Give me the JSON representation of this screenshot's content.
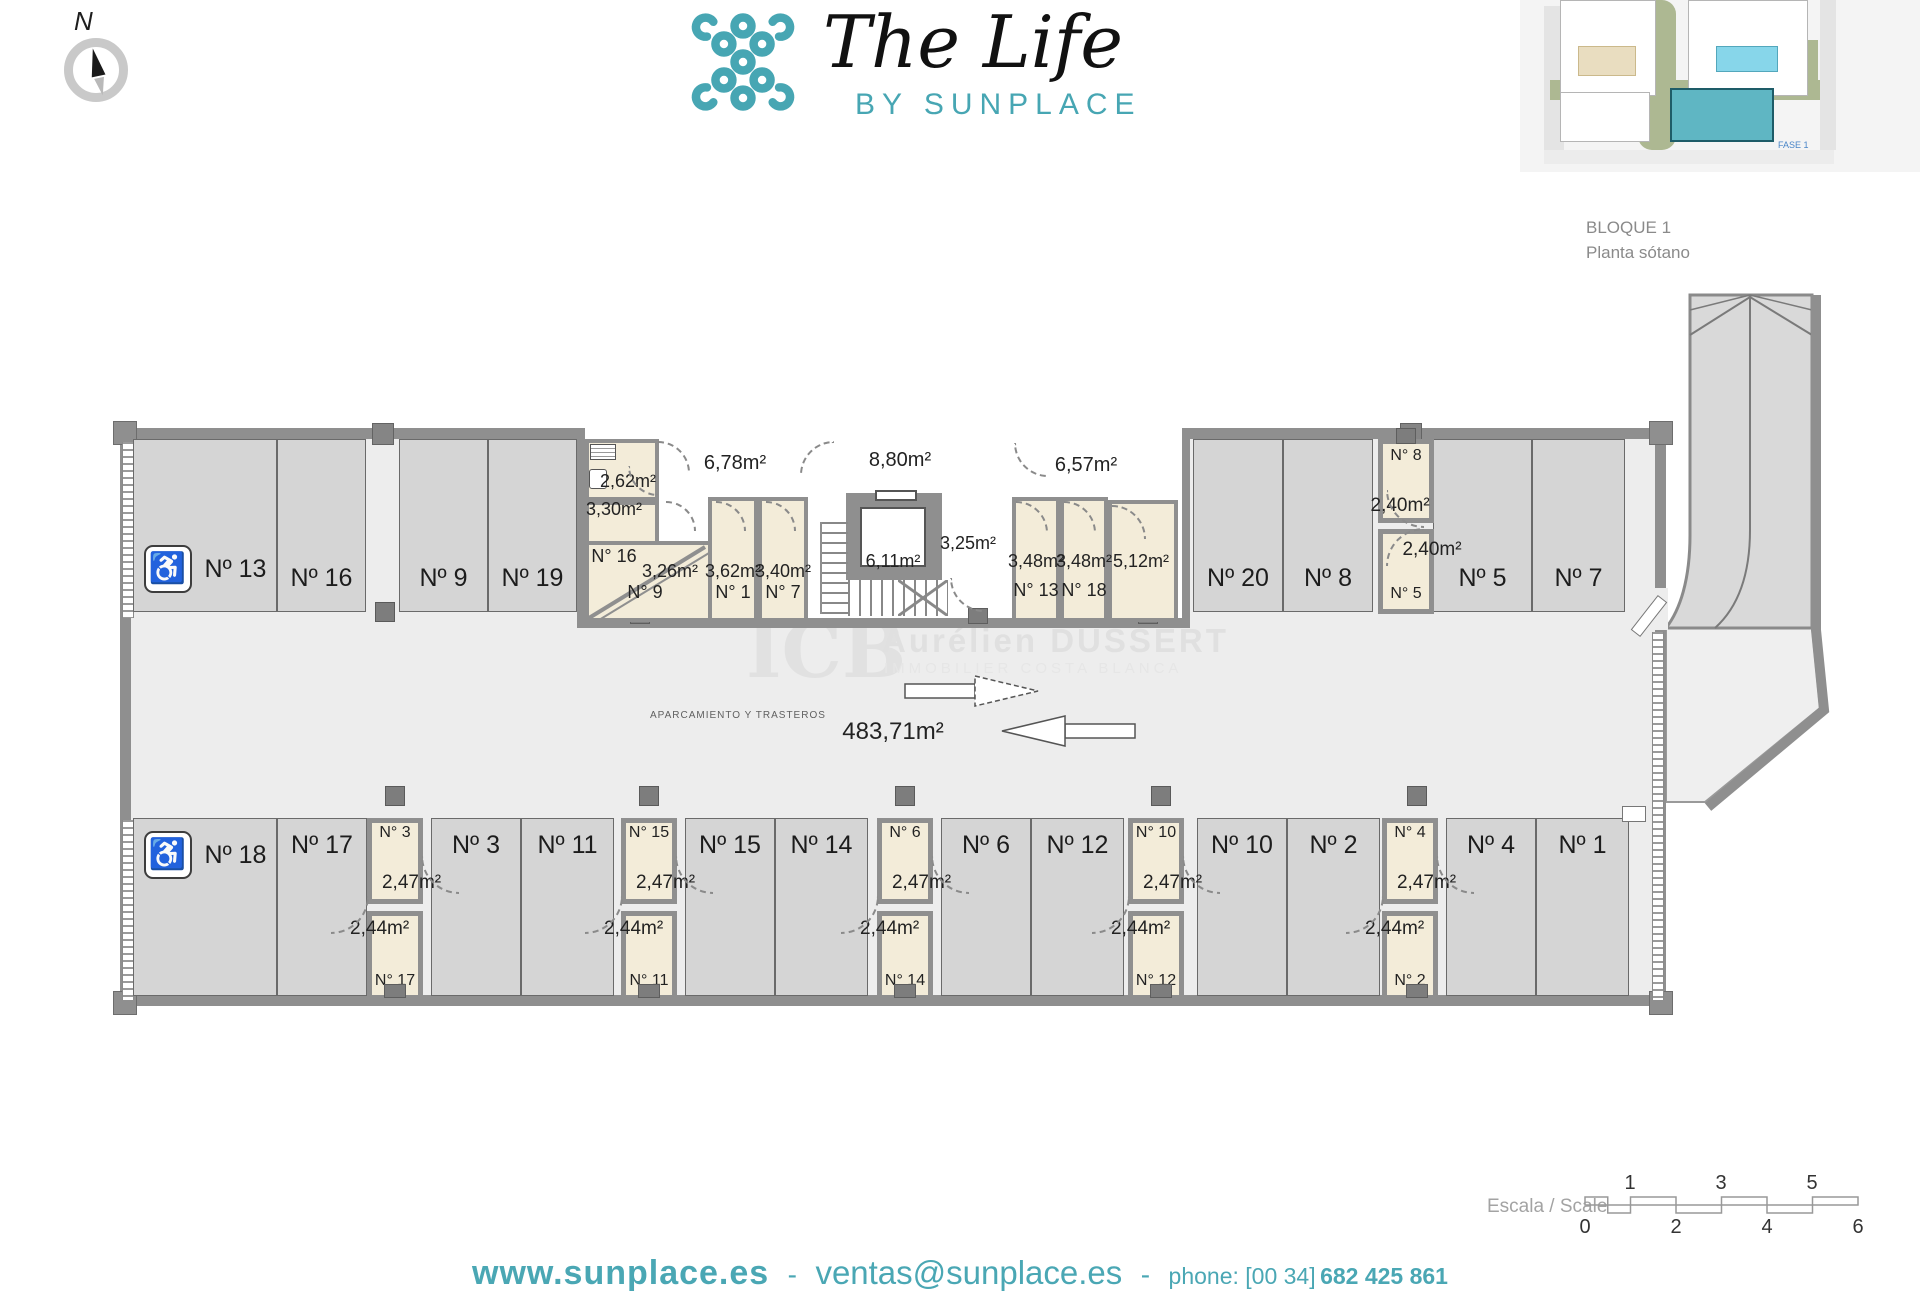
{
  "header": {
    "compass_label": "N",
    "logo_title": "The Life",
    "logo_subtitle": "BY SUNPLACE",
    "block_title": "BLOQUE 1",
    "block_subtitle": "Planta sótano",
    "sitemap_phase_label": "FASE 1"
  },
  "plan": {
    "garage_label": "APARCAMIENTO Y TRASTEROS",
    "garage_area": "483,71m²",
    "top_row": [
      {
        "label": "Nº 13",
        "accessible": true
      },
      {
        "label": "Nº 16"
      },
      {
        "label": "Nº 9"
      },
      {
        "label": "Nº 19"
      },
      {
        "label": "Nº 20"
      },
      {
        "label": "Nº 8"
      },
      {
        "label": "Nº 5"
      },
      {
        "label": "Nº 7"
      }
    ],
    "bottom_row": [
      {
        "label": "Nº 18",
        "accessible": true
      },
      {
        "label": "Nº 17"
      },
      {
        "label": "Nº 3"
      },
      {
        "label": "Nº 11"
      },
      {
        "label": "Nº 15"
      },
      {
        "label": "Nº 14"
      },
      {
        "label": "Nº 6"
      },
      {
        "label": "Nº 12"
      },
      {
        "label": "Nº 10"
      },
      {
        "label": "Nº 2"
      },
      {
        "label": "Nº 4"
      },
      {
        "label": "Nº 1"
      }
    ],
    "storage_columns": [
      {
        "top_label": "N° 3",
        "top_area": "2,47m²",
        "bottom_area": "2,44m²",
        "bottom_label": "N° 17"
      },
      {
        "top_label": "N° 15",
        "top_area": "2,47m²",
        "bottom_area": "2,44m²",
        "bottom_label": "N° 11"
      },
      {
        "top_label": "N° 6",
        "top_area": "2,47m²",
        "bottom_area": "2,44m²",
        "bottom_label": "N° 14"
      },
      {
        "top_label": "N° 10",
        "top_area": "2,47m²",
        "bottom_area": "2,44m²",
        "bottom_label": "N° 12"
      },
      {
        "top_label": "N° 4",
        "top_area": "2,47m²",
        "bottom_area": "2,44m²",
        "bottom_label": "N° 2"
      }
    ],
    "right_storage": {
      "top_label": "N° 8",
      "top_area": "2,40m²",
      "bottom_area": "2,40m²",
      "bottom_label": "N° 5"
    },
    "core": {
      "area_262": "2,62m²",
      "area_330": "3,30m²",
      "label_16": "N° 16",
      "area_326": "3,26m²",
      "label_9": "N° 9",
      "area_362": "3,62m²",
      "label_1": "N° 1",
      "area_340": "3,40m²",
      "label_7": "N° 7",
      "hall_left": "6,78m²",
      "hall_center": "8,80m²",
      "lift_area": "6,11m²",
      "lobby_area": "3,25m²",
      "hall_right": "6,57m²",
      "area_348_1": "3,48m²",
      "label_13": "N° 13",
      "area_348_2": "3,48m²",
      "label_18": "N° 18",
      "area_512": "5,12m²"
    }
  },
  "watermark": {
    "abbr": "ICB",
    "name": "Aurélien DUSSERT",
    "tagline": "IMMOBILIER COSTA BLANCA"
  },
  "scale_bar": {
    "label": "Escala / Scale",
    "top_ticks": [
      "1",
      "3",
      "5"
    ],
    "bottom_ticks": [
      "0",
      "2",
      "4",
      "6"
    ]
  },
  "footer": {
    "website": "www.sunplace.es",
    "separator": "-",
    "email": "ventas@sunplace.es",
    "phone_label": "phone: [00 34]",
    "phone_number": "682 425 861"
  },
  "icons": {
    "wheelchair": "♿"
  }
}
